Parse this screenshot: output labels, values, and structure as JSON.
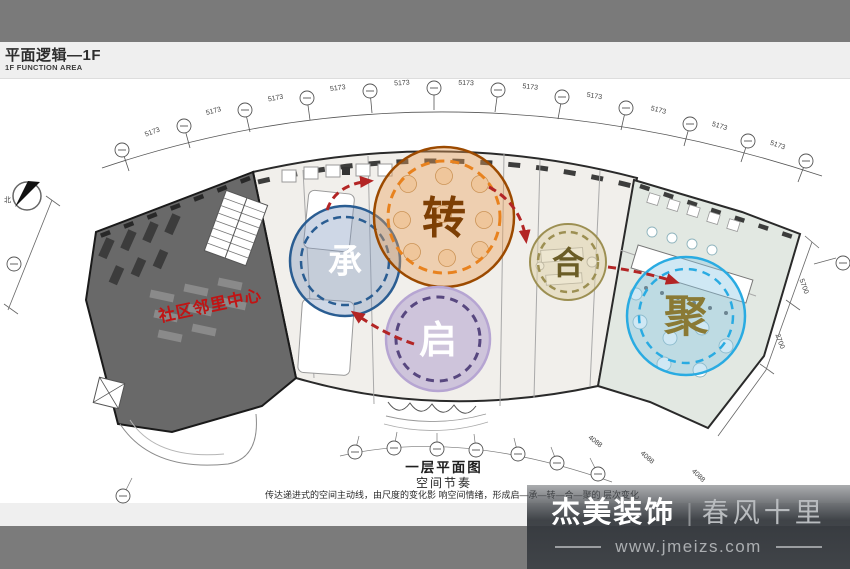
{
  "header": {
    "title": "平面逻辑—1F",
    "subtitle": "1F FUNCTION AREA"
  },
  "plan": {
    "red_label": "社区邻里中心",
    "north_label": "北",
    "drawing_title": "一层平面图",
    "drawing_subtitle": "空间节奏",
    "caption": "传达递进式的空间主动线，由尺度的变化影 响空间情绪，形成启—承—转—合—聚的 层次变化",
    "circles": [
      {
        "id": "cheng",
        "label": "承",
        "stroke": "#2a5d92",
        "fill": "rgba(125,150,190,0.38)",
        "text_color": "#ffffff"
      },
      {
        "id": "zhuan",
        "label": "转",
        "stroke": "#9c4a00",
        "dash": "#e8821e",
        "fill": "rgba(235,160,88,0.40)",
        "text_color": "#7d3f04"
      },
      {
        "id": "qi",
        "label": "启",
        "stroke": "#b6a5d2",
        "dash": "#57477f",
        "fill": "rgba(175,158,205,0.52)",
        "text_color": "#ffffff"
      },
      {
        "id": "he",
        "label": "合",
        "stroke": "#9c8f52",
        "fill": "rgba(222,210,170,0.55)",
        "text_color": "#6b5d26"
      },
      {
        "id": "ju",
        "label": "聚",
        "stroke": "#29abe2",
        "fill": "rgba(140,200,228,0.42)",
        "text_color": "#8a7a35"
      }
    ],
    "dims": {
      "arc": "5173",
      "bottom": "4088",
      "right_a": "5700",
      "right_b": "2700"
    },
    "flow_color": "#b32525"
  },
  "footer_logo": {
    "brand": "杰美装饰",
    "divider": "|",
    "slogan": "春风十里",
    "website": "www.jmeizs.com"
  }
}
